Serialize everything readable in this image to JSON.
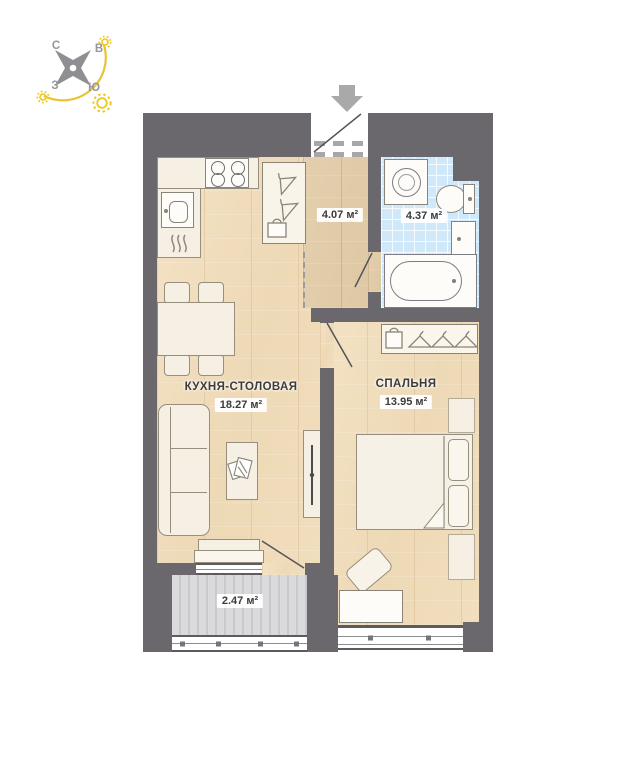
{
  "plan": {
    "title_hint": "apartment floor plan",
    "compass": {
      "north": "С",
      "east": "В",
      "west": "З",
      "south": "Ю"
    },
    "rooms": {
      "kitchen_living": {
        "name": "КУХНЯ-СТОЛОВАЯ",
        "area": "18.27 м²"
      },
      "bedroom": {
        "name": "СПАЛЬНЯ",
        "area": "13.95 м²"
      },
      "hall": {
        "area": "4.07 м²"
      },
      "bathroom": {
        "area": "4.37 м²"
      },
      "balcony": {
        "area": "2.47 м²"
      }
    },
    "colors": {
      "wall": "#6b686d",
      "wood_floor": "#f0dcbd",
      "hall_floor": "#e1ccA8",
      "bathroom_tile": "#cfe9fa",
      "balcony_floor": "#d6d6d9",
      "sun_accent": "#eec71e",
      "furniture": "#f5f0e3"
    }
  }
}
